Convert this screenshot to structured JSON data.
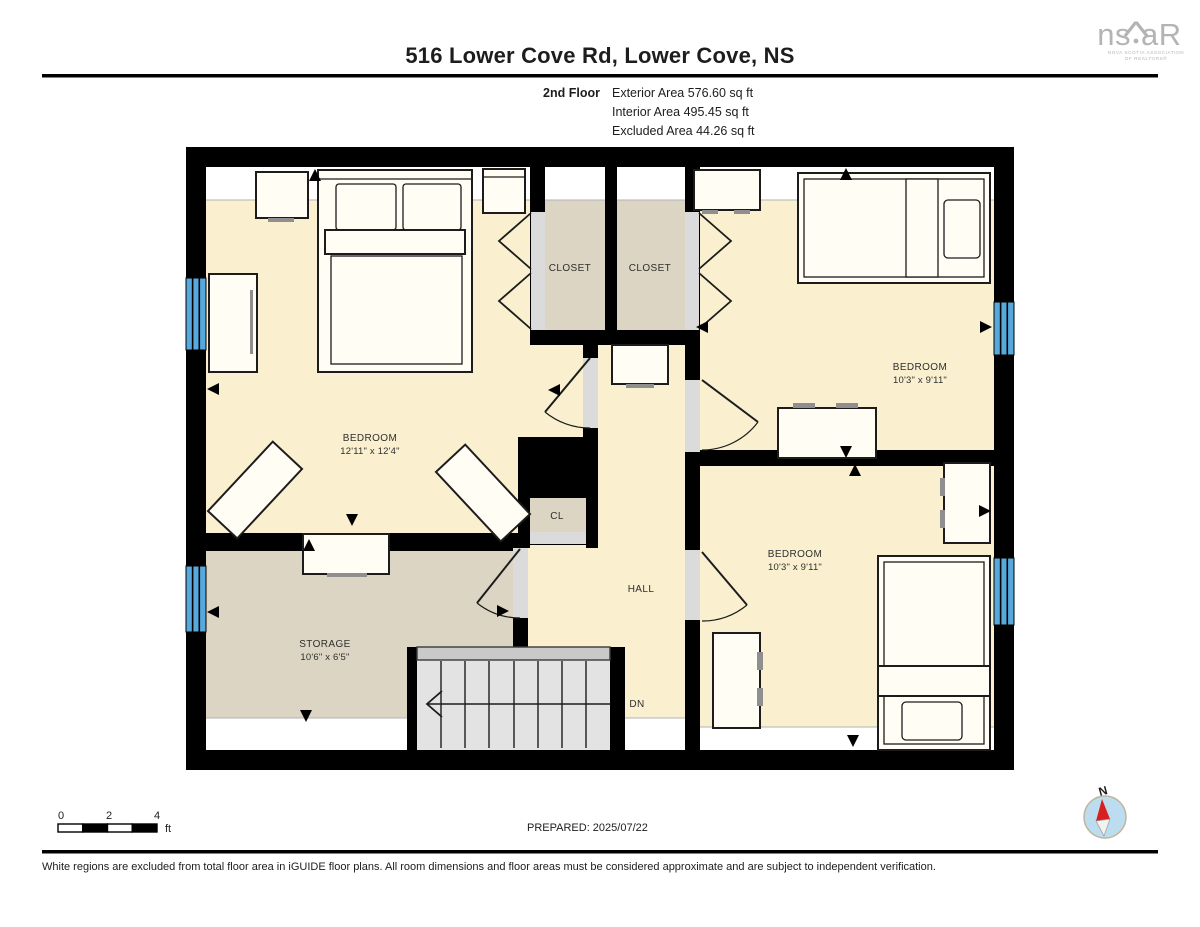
{
  "header": {
    "title": "516 Lower Cove Rd, Lower Cove, NS",
    "floor_label": "2nd Floor",
    "stats": [
      "Exterior Area 576.60 sq ft",
      "Interior Area 495.45 sq ft",
      "Excluded Area 44.26 sq ft"
    ]
  },
  "rooms": {
    "bedroom_left": {
      "name": "BEDROOM",
      "dims": "12'11\" x 12'4\""
    },
    "bedroom_top_right": {
      "name": "BEDROOM",
      "dims": "10'3\" x 9'11\""
    },
    "bedroom_bottom_right": {
      "name": "BEDROOM",
      "dims": "10'3\" x 9'11\""
    },
    "storage": {
      "name": "STORAGE",
      "dims": "10'6\" x 6'5\""
    },
    "closet_left": "CLOSET",
    "closet_right": "CLOSET",
    "cl": "CL",
    "hall": "HALL",
    "dn": "DN"
  },
  "scale": {
    "zero": "0",
    "two": "2",
    "four": "4",
    "unit": "ft"
  },
  "footer": {
    "prepared": "PREPARED: 2025/07/22",
    "disclaimer": "White regions are excluded from total floor area in iGUIDE floor plans. All room dimensions and floor areas must be considered approximate and are subject to independent verification."
  },
  "logo": {
    "ns": "ns",
    "ar": "aR",
    "caption1": "NOVA SCOTIA ASSOCIATION",
    "caption2": "OF REALTORS®"
  },
  "compass": {
    "north": "N"
  },
  "colors": {
    "floor": "#FAF0D0",
    "excluded": "#DDD5C3",
    "window": "#55A9DC",
    "threshold": "#DBDBDB",
    "stairs": "#E3E3E3"
  }
}
